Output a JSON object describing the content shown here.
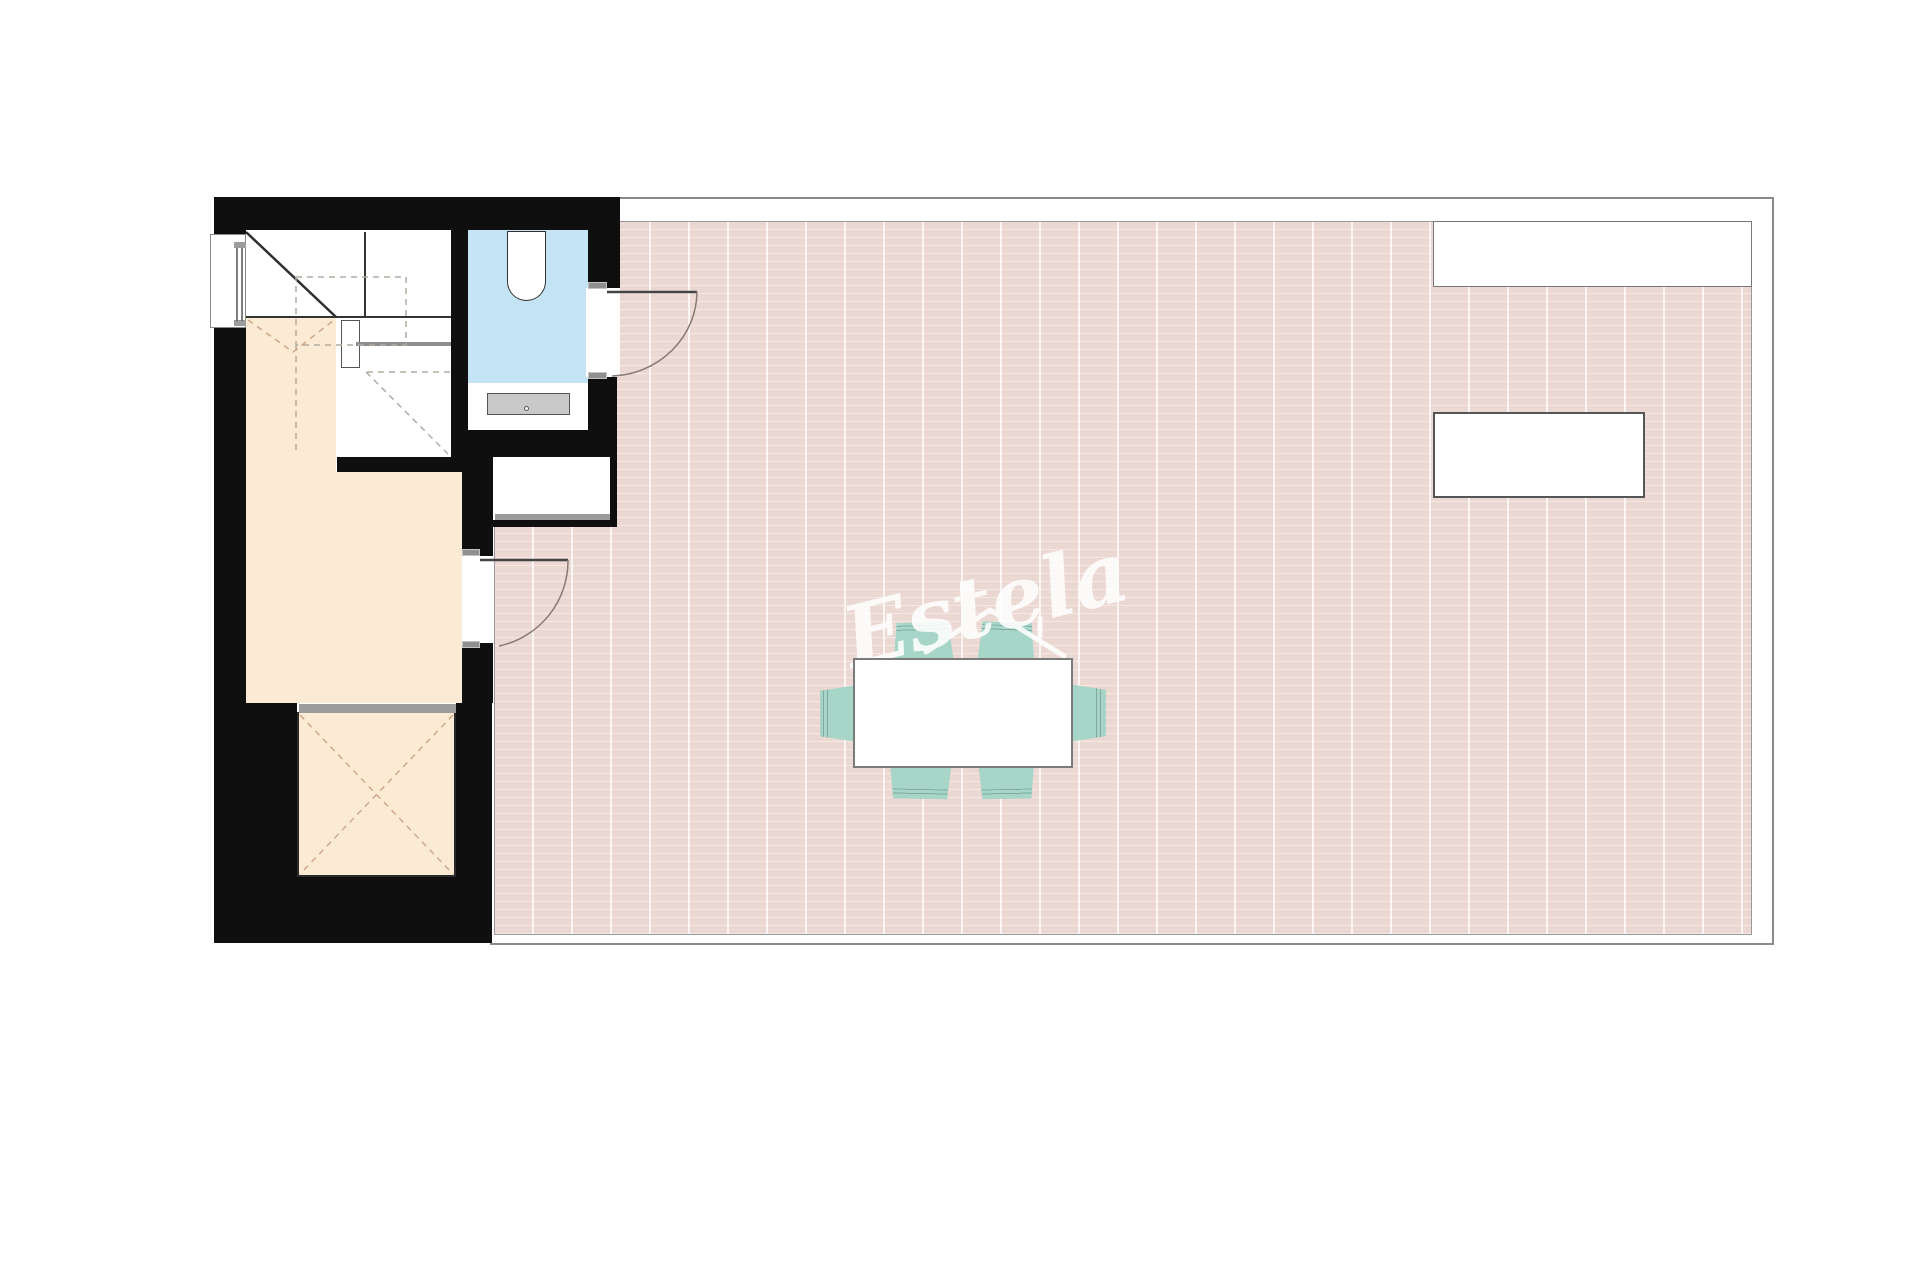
{
  "watermark": {
    "text": "Estela"
  },
  "palette": {
    "page-white": "#ffffff",
    "wall": "#0f0f0f",
    "tile-base": "#ecd8d2",
    "tile-line-h": "#f4e8e5",
    "tile-line-v": "#fbf6f4",
    "room-peach": "#fcebd4",
    "bath-blue": "#c4e3f5",
    "chair-teal": "#a7d6c9",
    "chair-line": "#7fa99e",
    "furniture-gray": "#c9c9c9",
    "sill-gray": "#9c9c9c",
    "outline-gray": "#8a8a8a",
    "dash-light": "#b9b2a8",
    "dash-warm": "#d6b096",
    "watermark-white": "#ffffff"
  }
}
